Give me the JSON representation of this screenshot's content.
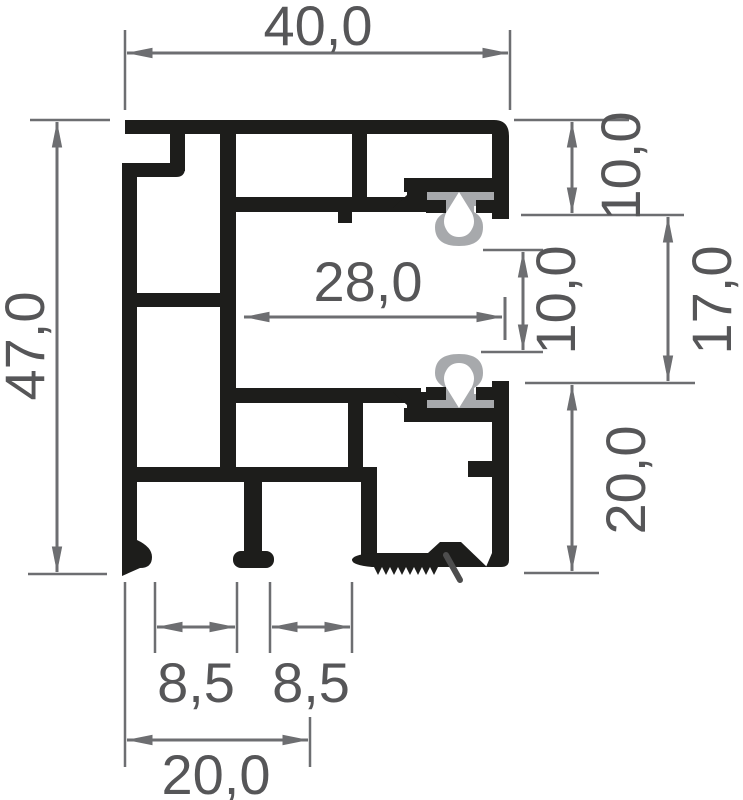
{
  "drawing": {
    "kind": "profile-cross-section"
  },
  "dimensions": {
    "top_width": "40,0",
    "left_height": "47,0",
    "right_top": "10,0",
    "right_middle": "17,0",
    "center_gap": "10,0",
    "inner_width": "28,0",
    "right_bottom": "20,0",
    "bottom_slot_left": "8,5",
    "bottom_slot_right": "8,5",
    "bottom_width": "20,0"
  },
  "colors": {
    "profile": "#1d1d1b",
    "gasket": "#a7a9ac",
    "dimension_lines": "#6d6e71",
    "dimension_text": "#565658",
    "latch_mark": "#4d4d4d",
    "background": "#ffffff"
  }
}
